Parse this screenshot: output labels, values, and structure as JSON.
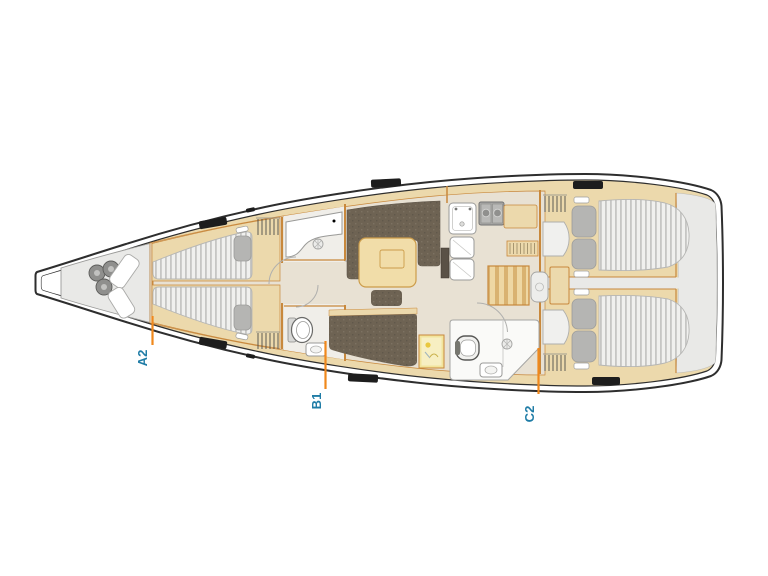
{
  "page": {
    "background": "#ffffff"
  },
  "diagram": {
    "type": "yacht-deck-plan",
    "cabin_labels": [
      {
        "id": "A2",
        "text": "A2"
      },
      {
        "id": "B1",
        "text": "B1"
      },
      {
        "id": "C2",
        "text": "C2"
      }
    ],
    "icons": [
      "windlass-icon",
      "hanger-rack-icon",
      "shower-drain-icon",
      "toilet-icon",
      "sink-icon",
      "stove-icon",
      "companionway-steps",
      "deck-hatch-icon"
    ]
  },
  "colors": {
    "hull-line": "#2e2e2e",
    "deck-wood": "#ecd9ac",
    "trim": "#c8883c",
    "floor": "#e8e1d3",
    "floor-light": "#f0eee9",
    "gray-zone": "#e9e9e7",
    "mattress": "#f0f0ee",
    "mattress-stripe": "#c6c6c4",
    "pillow": "#b5b5b3",
    "settee": "#6e6353",
    "table-wood": "#f1dda9",
    "steps-dark": "#d9b270",
    "steps-light": "#eed7a3",
    "hatch": "#1d1d1d",
    "stove": "#a9a9a7",
    "chart-yellow": "#f2e49c",
    "label-blue": "#1f7ca6",
    "tick-orange": "#f0881c"
  }
}
